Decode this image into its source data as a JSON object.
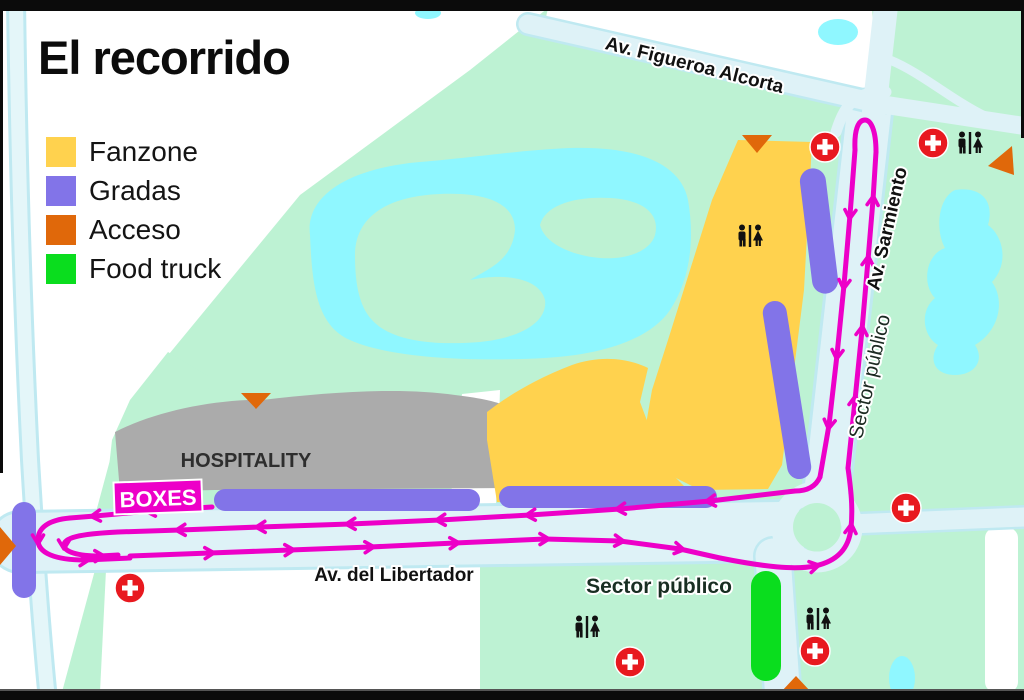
{
  "title": "El recorrido",
  "legend": {
    "items": [
      {
        "label": "Fanzone",
        "color": "#ffd24e"
      },
      {
        "label": "Gradas",
        "color": "#8274e8"
      },
      {
        "label": "Acceso",
        "color": "#e0680a"
      },
      {
        "label": "Food truck",
        "color": "#0add1e"
      }
    ]
  },
  "map": {
    "streets": {
      "figueroa_alcorta": "Av. Figueroa Alcorta",
      "sarmiento": "Av. Sarmiento",
      "libertador": "Av. del Libertador"
    },
    "areas": {
      "hospitality": "HOSPITALITY",
      "boxes": "BOXES",
      "sector_publico_east": "Sector público",
      "sector_publico_south": "Sector público"
    },
    "colors": {
      "route": "#ed00c8",
      "park": "#bdf2d3",
      "water": "#8ff7ff",
      "road": "#def2f7",
      "road_edge": "#bfe9f1",
      "hospitality_area": "#ababab",
      "fanzone": "#ffd24e",
      "gradas": "#8274e8",
      "acceso": "#e0680a",
      "food_truck": "#0add1e",
      "first_aid": "#e8191f"
    },
    "icons": {
      "first_aid": "first-aid-cross-icon",
      "restrooms": "restrooms-icon",
      "access": "access-triangle-icon"
    }
  }
}
